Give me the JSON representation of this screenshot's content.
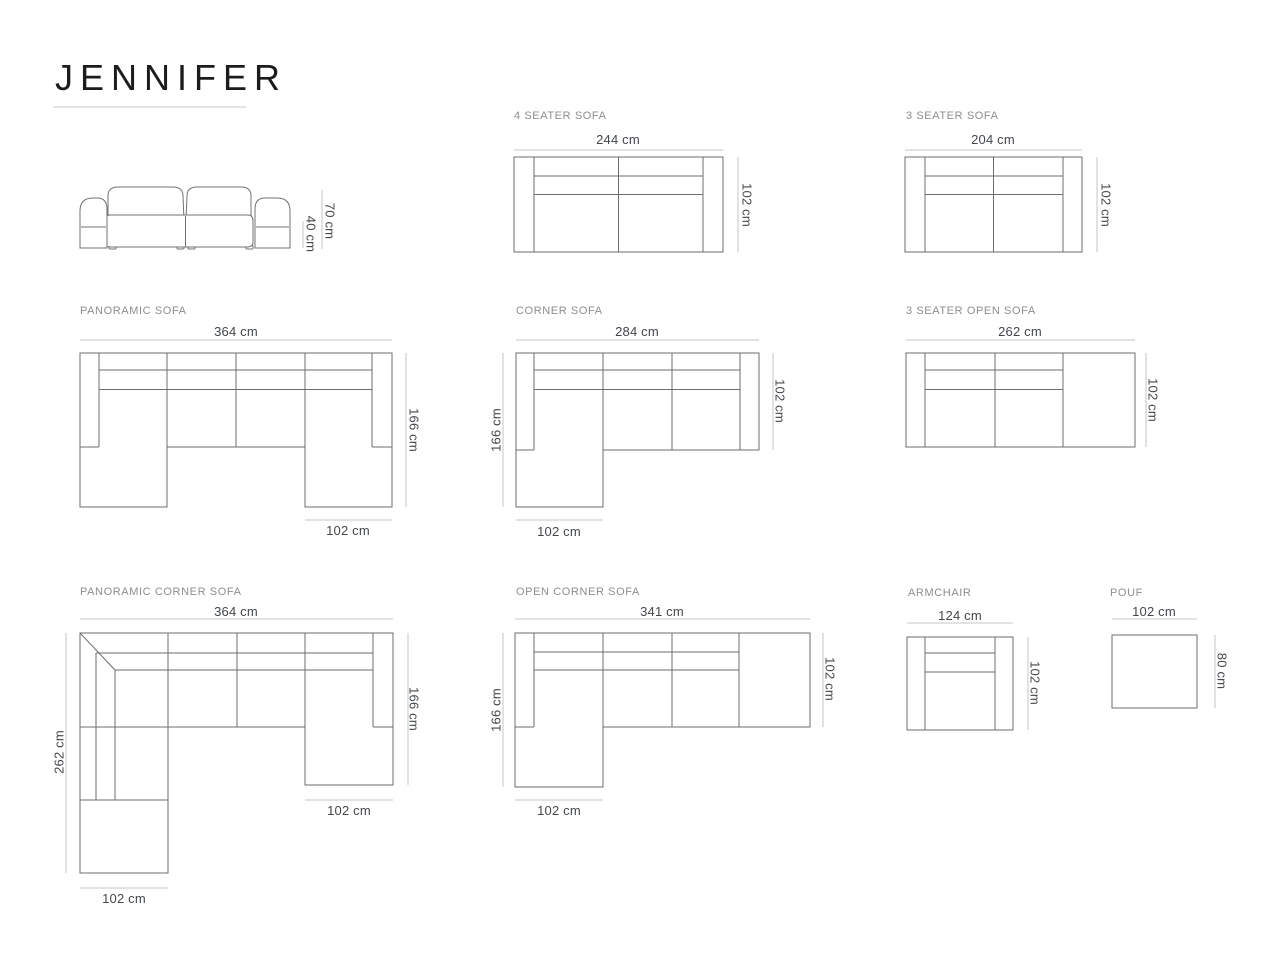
{
  "title": "JENNIFER",
  "unit": "cm",
  "colors": {
    "background": "#ffffff",
    "title_text": "#1a1c1d",
    "section_label": "#8a8e91",
    "dimension_text": "#43474b",
    "drawing_line": "#6b6e71",
    "dimension_line": "#c2c5c7"
  },
  "figures": {
    "hero": {
      "total_height": "70 cm",
      "seat_height": "40 cm"
    },
    "four_seater": {
      "label": "4 SEATER SOFA",
      "width": "244 cm",
      "depth": "102 cm"
    },
    "three_seater": {
      "label": "3 SEATER SOFA",
      "width": "204 cm",
      "depth": "102 cm"
    },
    "panoramic": {
      "label": "PANORAMIC SOFA",
      "width": "364 cm",
      "depth": "166 cm",
      "chaise_width": "102 cm"
    },
    "corner": {
      "label": "CORNER SOFA",
      "width": "284 cm",
      "left_depth": "166 cm",
      "right_depth": "102 cm",
      "chaise_width": "102 cm"
    },
    "open_three_seater": {
      "label": "3 SEATER OPEN SOFA",
      "width": "262 cm",
      "depth": "102 cm"
    },
    "panoramic_corner": {
      "label": "PANORAMIC CORNER SOFA",
      "width": "364 cm",
      "left_depth": "262 cm",
      "right_depth": "166 cm",
      "right_chaise_width": "102 cm",
      "bottom_chaise_width": "102 cm"
    },
    "open_corner": {
      "label": "OPEN CORNER SOFA",
      "width": "341 cm",
      "left_depth": "166 cm",
      "right_depth": "102 cm",
      "chaise_width": "102 cm"
    },
    "armchair": {
      "label": "ARMCHAIR",
      "width": "124 cm",
      "depth": "102 cm"
    },
    "pouf": {
      "label": "POUF",
      "width": "102 cm",
      "depth": "80 cm"
    }
  }
}
